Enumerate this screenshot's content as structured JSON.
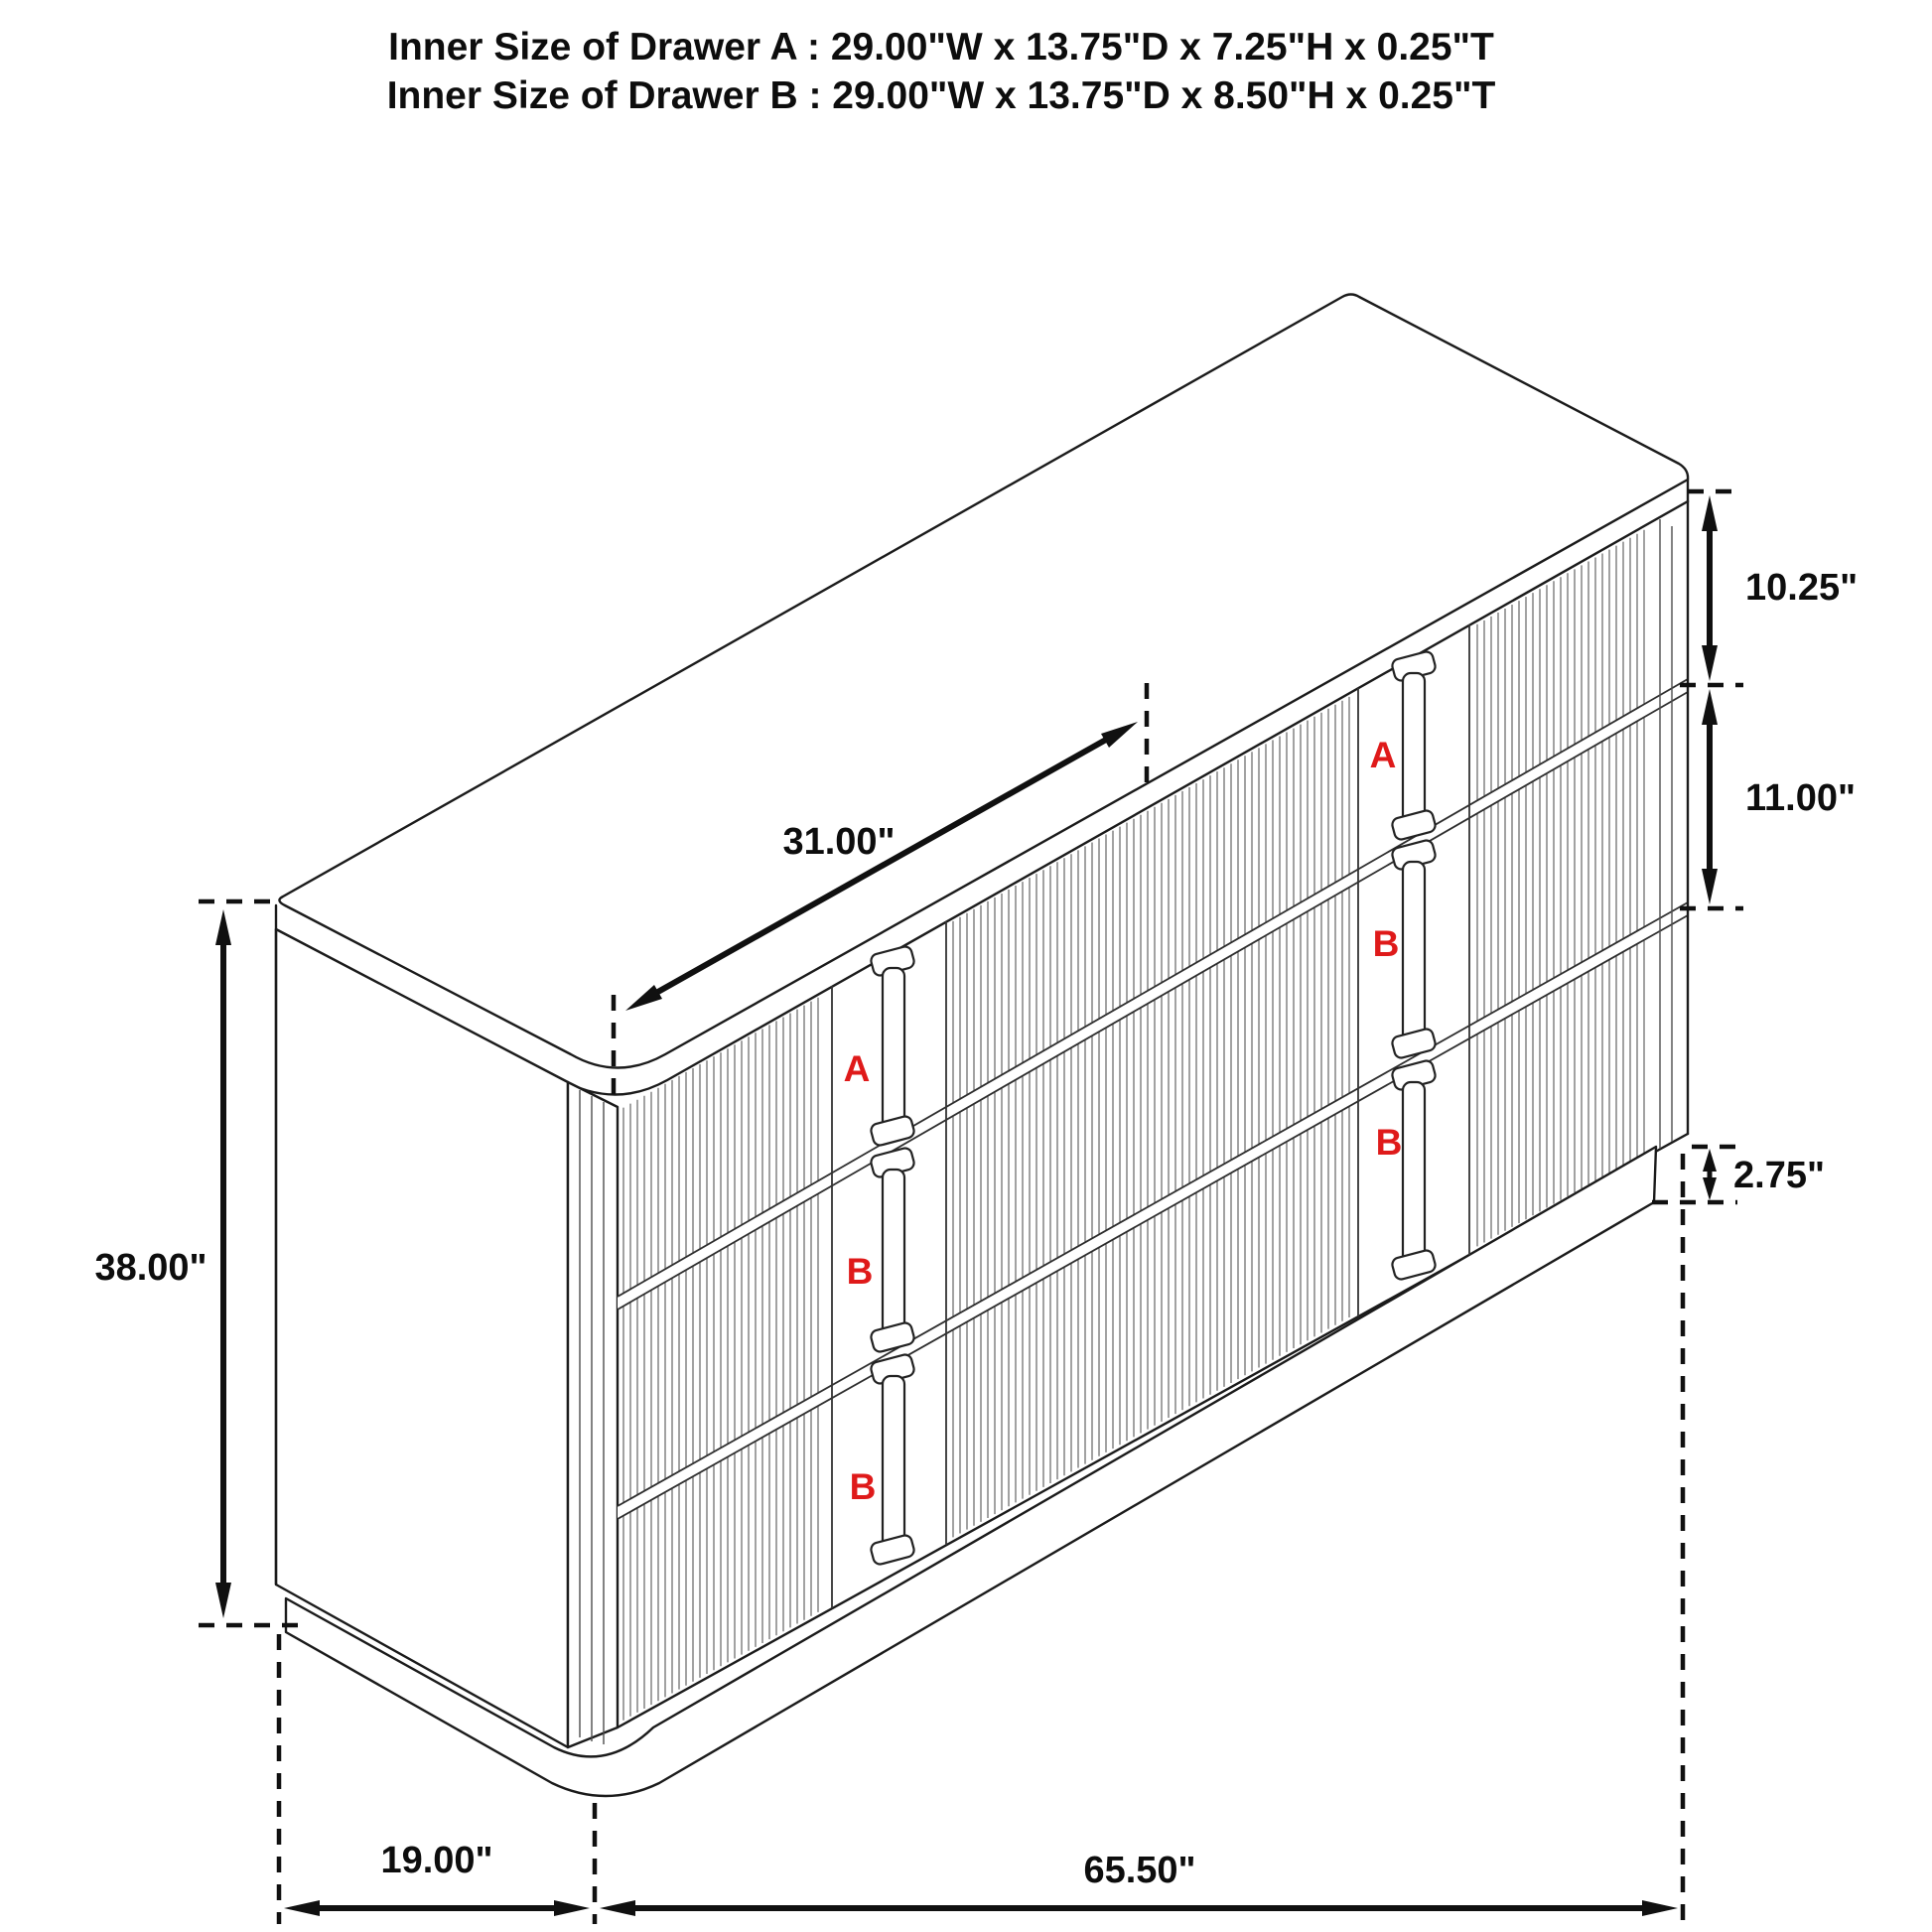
{
  "title": {
    "line1": "Inner Size of Drawer A : 29.00\"W x 13.75\"D x 7.25\"H x 0.25\"T",
    "line2": "Inner Size of Drawer B : 29.00\"W x 13.75\"D x 8.50\"H x 0.25\"T"
  },
  "dimensions": {
    "overall_height": "38.00\"",
    "overall_depth": "19.00\"",
    "overall_width": "65.50\"",
    "drawer_width": "31.00\"",
    "top_drawer_height": "10.25\"",
    "middle_drawer_height": "11.00\"",
    "base_height": "2.75\""
  },
  "drawer_labels": {
    "left": [
      "A",
      "B",
      "B"
    ],
    "right": [
      "A",
      "B",
      "B"
    ]
  },
  "colors": {
    "label_red": "#df1a1a",
    "line": "#161616"
  }
}
